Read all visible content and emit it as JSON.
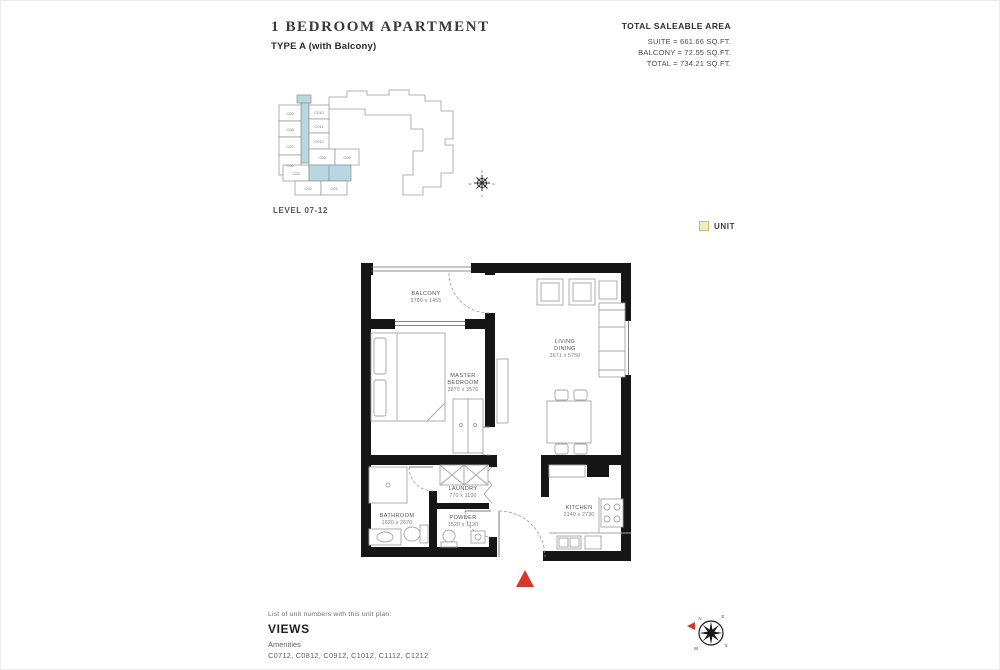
{
  "header": {
    "title": "1 BEDROOM APARTMENT",
    "subtitle": "TYPE A (with Balcony)",
    "area_heading": "TOTAL SALEABLE AREA",
    "area_lines": [
      "SUITE = 661.66 SQ.FT.",
      "BALCONY = 72.55 SQ.FT.",
      "TOTAL = 734.21 SQ.FT."
    ]
  },
  "keyplan": {
    "level_label": "LEVEL 07-12",
    "unit_labels": [
      "C010",
      "C011",
      "C012",
      "C09",
      "C08",
      "C07",
      "C06",
      "C05",
      "C04",
      "C03",
      "C02",
      "C01"
    ],
    "highlighted_unit": "C012",
    "highlight_color": "#f0ecc3",
    "highlight_border": "#c9bd72",
    "corridor_color": "#b9d7e3"
  },
  "legend": {
    "unit_label": "UNIT",
    "swatch_color": "#f0ecc3"
  },
  "floorplan": {
    "rooms": {
      "balcony": {
        "name": "BALCONY",
        "dims": "3780 x 1455"
      },
      "master_bedroom": {
        "name1": "MASTER",
        "name2": "BEDROOM",
        "dims": "3870 x 3570"
      },
      "living_dining": {
        "name1": "LIVING",
        "name2": "DINING",
        "dims": "3671 x 5750"
      },
      "laundry": {
        "name": "LAUNDRY",
        "dims": "770 x 1100"
      },
      "bathroom": {
        "name": "BATHROOM",
        "dims": "1620 x 2670"
      },
      "powder": {
        "name": "POWDER",
        "dims": "1520 x 1120"
      },
      "kitchen": {
        "name": "KITCHEN",
        "dims": "2140 x 2730"
      }
    },
    "entry_marker_color": "#d9372e"
  },
  "footer": {
    "list_heading": "List of unit numbers with this unit plan:",
    "views_label": "VIEWS",
    "amenities_label": "Amenities",
    "unit_numbers": "C0712, C0812, C0912, C1012, C1112, C1212"
  },
  "compass": {
    "n": "N",
    "e": "E",
    "s": "S",
    "w": "W"
  }
}
